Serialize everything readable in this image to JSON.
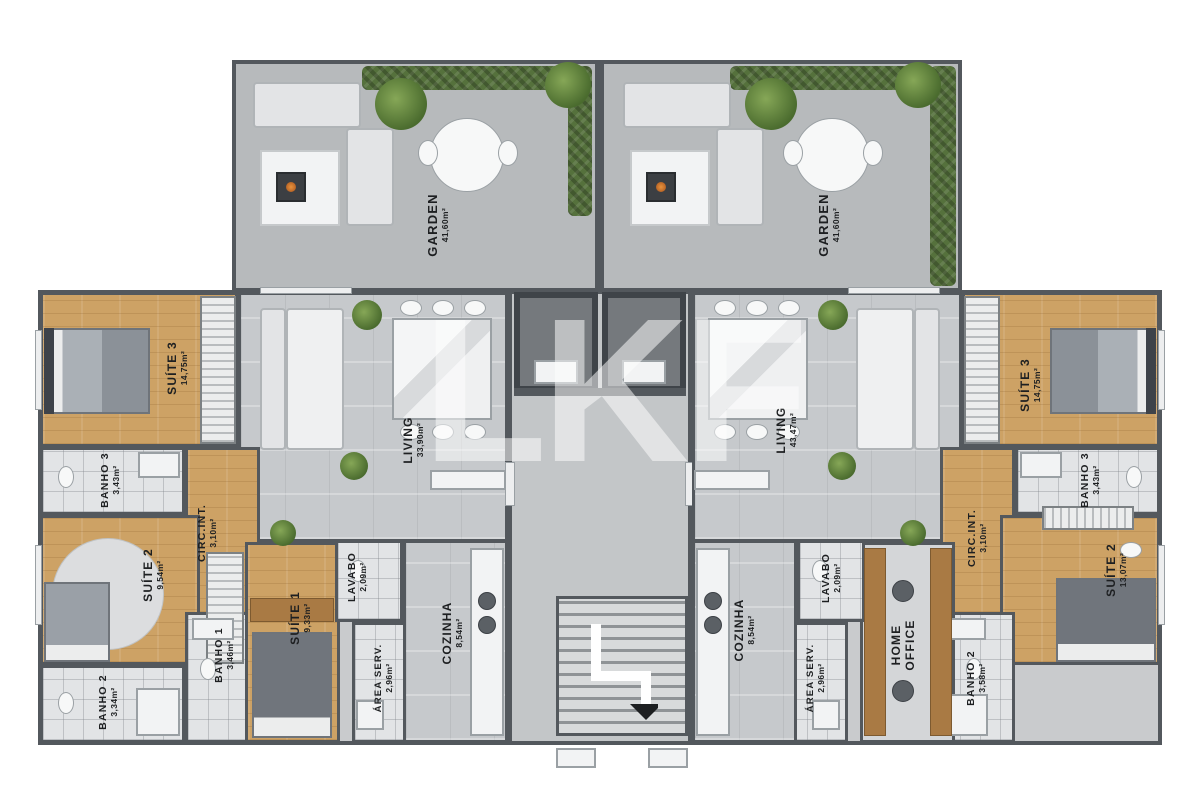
{
  "watermark": "LKF",
  "gardens": [
    {
      "label": "GARDEN",
      "area": "41,60m²"
    },
    {
      "label": "GARDEN",
      "area": "41,60m²"
    }
  ],
  "apartment_left": {
    "living": {
      "label": "LIVING",
      "area": "33,90m²"
    },
    "suite1": {
      "label": "SUÍTE 1",
      "area": "9,33m²"
    },
    "suite2": {
      "label": "SUÍTE 2",
      "area": "9,54m²"
    },
    "suite3": {
      "label": "SUÍTE 3",
      "area": "14,75m²"
    },
    "banho1": {
      "label": "BANHO 1",
      "area": "3,46m²"
    },
    "banho2": {
      "label": "BANHO 2",
      "area": "3,34m²"
    },
    "banho3": {
      "label": "BANHO 3",
      "area": "3,43m²"
    },
    "circ": {
      "label": "CIRC.INT.",
      "area": "3,10m²"
    },
    "lavabo": {
      "label": "LAVABO",
      "area": "2,09m²"
    },
    "cozinha": {
      "label": "COZINHA",
      "area": "8,54m²"
    },
    "area_serv": {
      "label": "ÁREA SERV.",
      "area": "2,96m²"
    }
  },
  "apartment_right": {
    "living": {
      "label": "LIVING",
      "area": "43,47m²"
    },
    "home_office": {
      "label": "HOME",
      "label2": "OFFICE"
    },
    "suite2": {
      "label": "SUÍTE 2",
      "area": "13,07m²"
    },
    "suite3": {
      "label": "SUÍTE 3",
      "area": "14,75m²"
    },
    "banho2": {
      "label": "BANHO 2",
      "area": "3,58m²"
    },
    "banho3": {
      "label": "BANHO 3",
      "area": "3,43m²"
    },
    "circ": {
      "label": "CIRC.INT.",
      "area": "3,10m²"
    },
    "lavabo": {
      "label": "LAVABO",
      "area": "2,09m²"
    },
    "cozinha": {
      "label": "COZINHA",
      "area": "8,54m²"
    },
    "area_serv": {
      "label": "ÁREA SERV.",
      "area": "2,96m²"
    }
  }
}
